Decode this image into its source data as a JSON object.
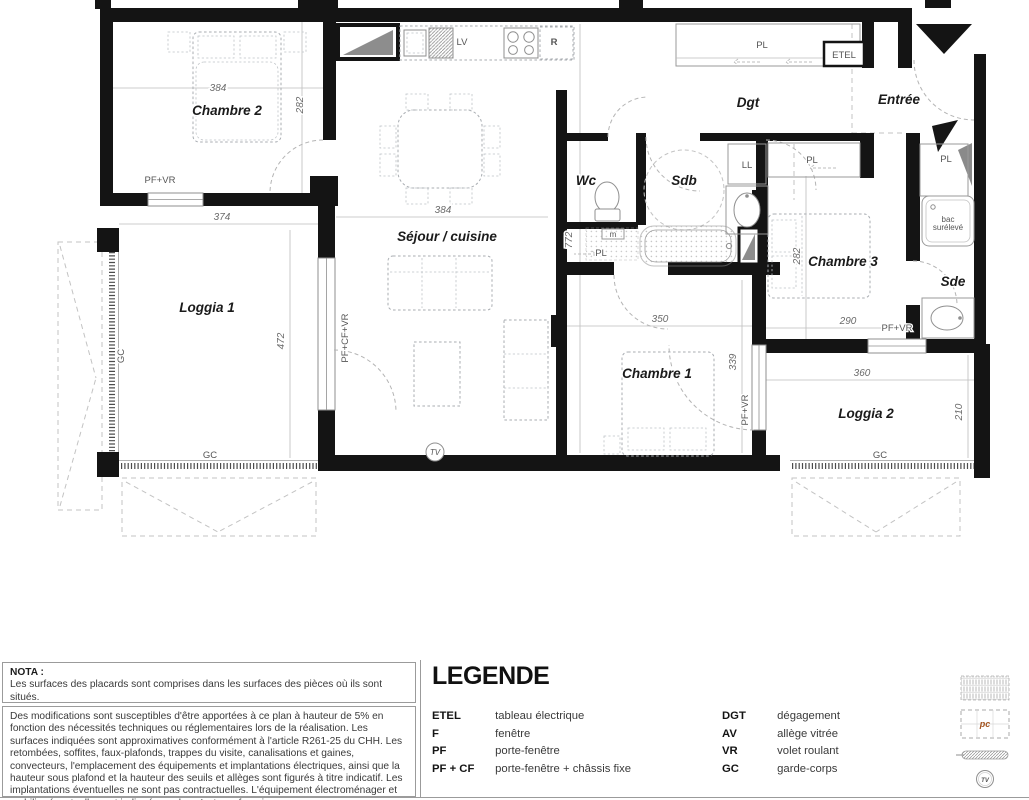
{
  "plan": {
    "rooms": {
      "chambre2": "Chambre 2",
      "loggia1": "Loggia 1",
      "sejour": "Séjour / cuisine",
      "wc": "Wc",
      "sdb": "Sdb",
      "dgt": "Dgt",
      "entree": "Entrée",
      "chambre3": "Chambre 3",
      "sde": "Sde",
      "chambre1": "Chambre 1",
      "loggia2": "Loggia 2"
    },
    "dimensions": {
      "chambre2_w": "384",
      "chambre2_h": "282",
      "loggia1_w": "374",
      "loggia1_h": "472",
      "sejour_w": "384",
      "sejour_h": "772",
      "chambre1_w": "350",
      "chambre1_h": "339",
      "chambre3_w": "290",
      "chambre3_h": "282",
      "loggia2_w": "360",
      "loggia2_h": "210"
    },
    "annotations": {
      "pf_vr": "PF+VR",
      "pf_cf_vr": "PF+CF+VR",
      "gc": "GC",
      "pl": "PL",
      "etel": "ETEL",
      "ll": "LL",
      "lv": "LV",
      "r": "R",
      "m": "m",
      "tv": "TV",
      "bac_line1": "bac",
      "bac_line2": "surélevé"
    }
  },
  "nota": {
    "title": "NOTA :",
    "line1": "Les surfaces des placards sont comprises dans les surfaces des pièces où ils sont situés.",
    "paragraph": "Des modifications sont susceptibles d'être apportées à ce plan à hauteur de 5% en fonction des nécessités techniques ou réglementaires lors de la réalisation. Les surfaces indiquées sont approximatives conformément à l'article R261-25 du CHH. Les retombées, soffites, faux-plafonds, trappes du visite, canalisations et gaines, convecteurs, l'emplacement des équipements et implantations électriques, ainsi que la hauteur sous plafond et la hauteur des seuils et allèges sont figurés à titre indicatif. Les implantations éventuelles ne sont pas contractuelles. L'équipement électroménager et mobilier éventuellement indiqué sur plan n'est pas fourni."
  },
  "legend": {
    "title": "LEGENDE",
    "col1": [
      {
        "abbr": "ETEL",
        "label": "tableau électrique"
      },
      {
        "abbr": "F",
        "label": "fenêtre"
      },
      {
        "abbr": "PF",
        "label": "porte-fenêtre"
      },
      {
        "abbr": "PF + CF",
        "label": "porte-fenêtre + châssis fixe"
      }
    ],
    "col2": [
      {
        "abbr": "DGT",
        "label": "dégagement"
      },
      {
        "abbr": "AV",
        "label": "allège vitrée"
      },
      {
        "abbr": "VR",
        "label": "volet roulant"
      },
      {
        "abbr": "GC",
        "label": "garde-corps"
      }
    ],
    "symbols": {
      "pc": "pc",
      "tv": "TV"
    }
  },
  "colors": {
    "wall": "#141414",
    "line": "#999999",
    "dash": "#b4b4b4",
    "pc_accent": "#a35420"
  }
}
